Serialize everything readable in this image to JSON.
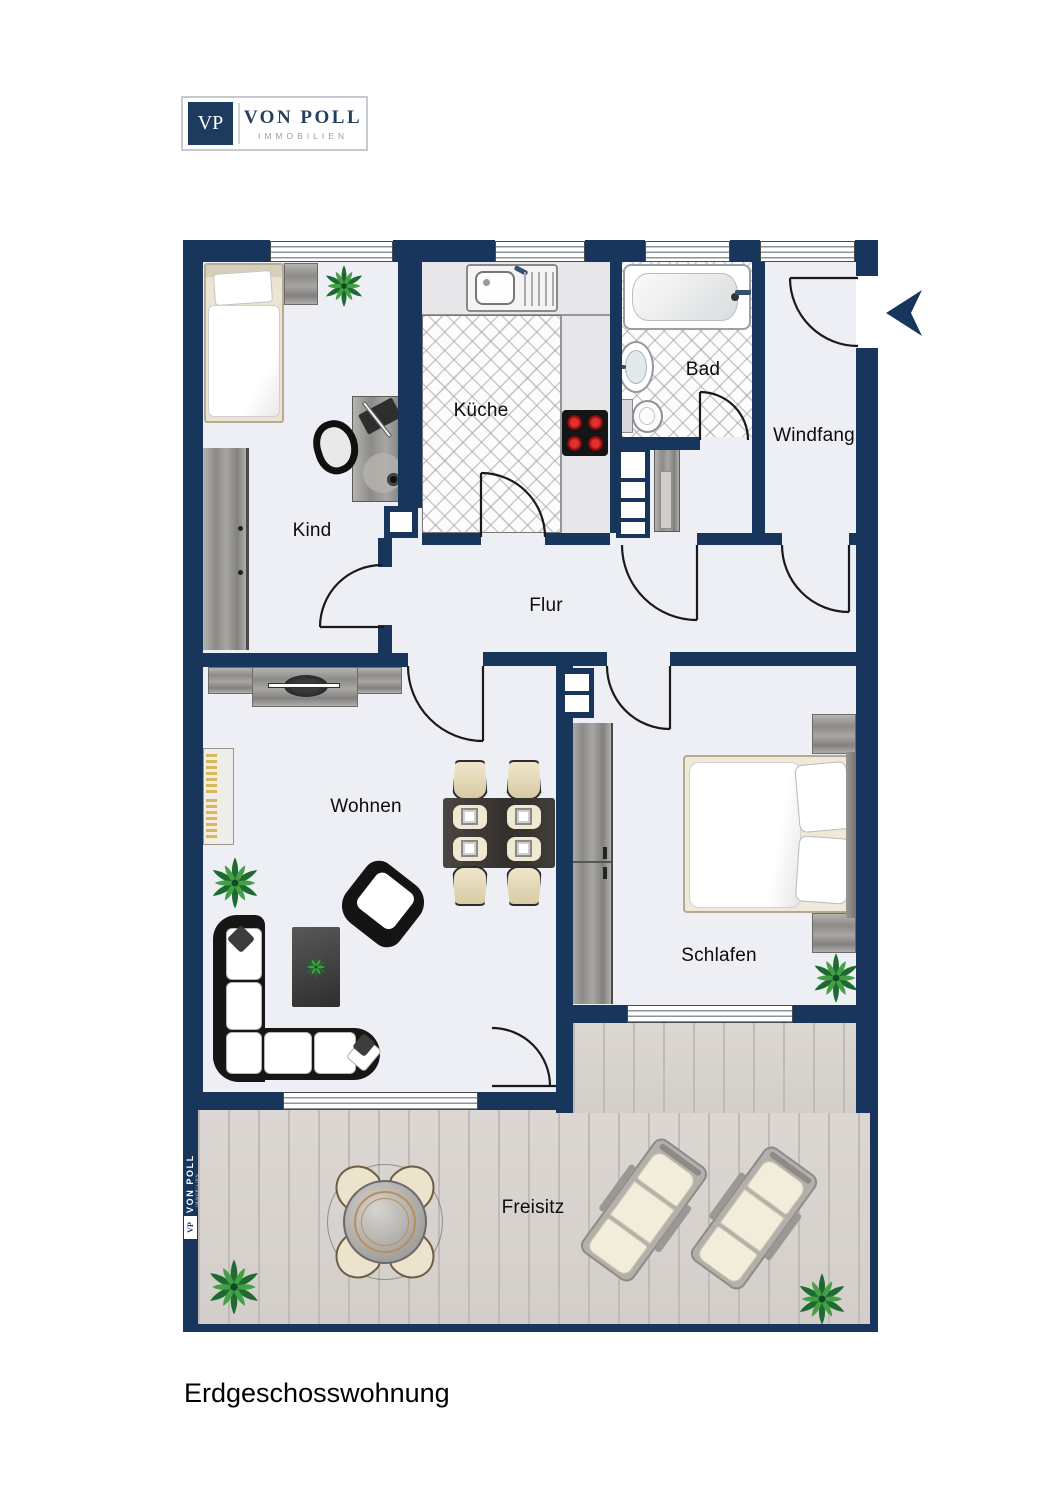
{
  "logo": {
    "initials": "VP",
    "name": "VON POLL",
    "subtitle": "IMMOBILIEN"
  },
  "rooms": {
    "kind": "Kind",
    "kueche": "Küche",
    "bad": "Bad",
    "windfang": "Windfang",
    "flur": "Flur",
    "wohnen": "Wohnen",
    "schlafen": "Schlafen",
    "freisitz": "Freisitz"
  },
  "caption": "Erdgeschosswohnung",
  "watermark": {
    "name": "VON POLL",
    "subtitle": "IMMOBILIEN",
    "initials": "VP"
  },
  "icons": {
    "entrance_arrow": "left-arrow",
    "plant": "potted-plant"
  },
  "colors": {
    "wall": "#18365c",
    "floor": "#edeff4",
    "deck": "#d8d3cf",
    "logo_navy": "#1d3a5f",
    "logo_gray": "#979da6",
    "burner_red": "#cf1313"
  }
}
